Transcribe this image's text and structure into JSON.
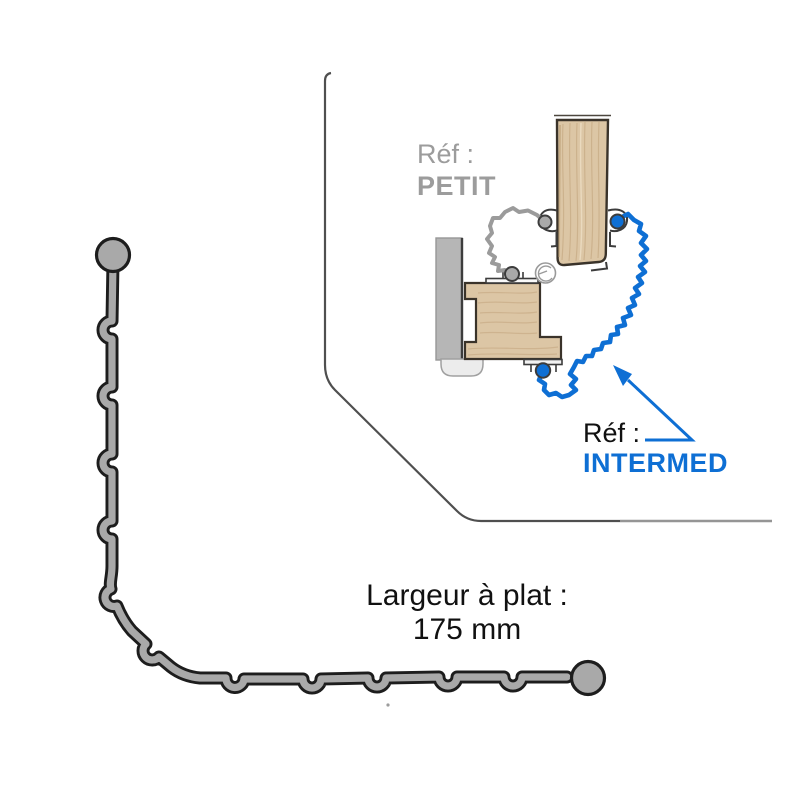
{
  "page": {
    "width": 800,
    "height": 800,
    "background": "#ffffff"
  },
  "inset": {
    "ref_petit": {
      "prefix": "Réf :",
      "name": "PETIT"
    },
    "ref_intermed": {
      "prefix": "Réf :",
      "name": "INTERMED"
    }
  },
  "dimension": {
    "label": "Largeur à plat :",
    "value": "175 mm",
    "value_mm": 175
  },
  "colors": {
    "profile_fill": "#a9a9a9",
    "profile_outline": "#1d1d1d",
    "wood_fill": "#dcc6a5",
    "wood_grain": "#c3a57e",
    "wood_grain_light": "#eddfc6",
    "wood_outline": "#3a332a",
    "wall_fill": "#b6b6b6",
    "wall_outline": "#979797",
    "wall_edge_dark": "#3d3d3d",
    "seal_gray": "#9b9b9b",
    "accent_blue": "#0e6fd4",
    "text_black": "#111111",
    "text_gray": "#9c9c9c",
    "border_dark": "#4f4f4f",
    "border_light": "#959595",
    "pill_fill": "#ececec",
    "pill_outline": "#a0a0a0",
    "metal_outline": "#3c3c3c",
    "symbol_gray": "#9a9a9a",
    "page_bg": "#ffffff"
  }
}
